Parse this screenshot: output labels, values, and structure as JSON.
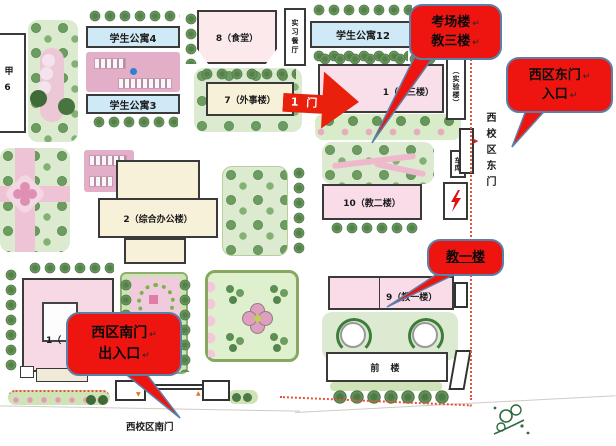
{
  "colors": {
    "callout_red": "#ee1511",
    "callout_border": "#5b80a8",
    "arrow_red": "#e9200c",
    "boundary_red": "#e8503a"
  },
  "callouts": {
    "exam": {
      "line1": "考场楼",
      "line2": "教三楼"
    },
    "east_gate": {
      "line1": "西区东门",
      "line2": "入口"
    },
    "teach1_note": {
      "line1": "教一楼"
    },
    "south_gate": {
      "line1": "西区南门",
      "line2": "出入口"
    }
  },
  "arrow": {
    "label": "1 门"
  },
  "buildings": {
    "jia6": "甲6",
    "apt4": "学生公寓4",
    "apt3": "学生公寓3",
    "apt12": "学生公寓12",
    "canteen": "8（食堂）",
    "practice_restaurant": "实习餐厅",
    "foreign_affairs": "7（外事楼）",
    "teach3": "1（教三楼）",
    "lab": "（实验楼）",
    "admin": "2（综合办公楼）",
    "teach2": "10（教二楼）",
    "garage": "车库",
    "teach1": "9（教一楼）",
    "building1": "1（",
    "front_building": "前 楼"
  },
  "labels": {
    "east_gate_vertical": "西校区东门",
    "south_gate_horizontal": "西校区南门",
    "plaza": "广场",
    "return_mark": "↵",
    "east_marker": "▶",
    "south_marker_down": "▼",
    "south_marker_up": "▲"
  }
}
